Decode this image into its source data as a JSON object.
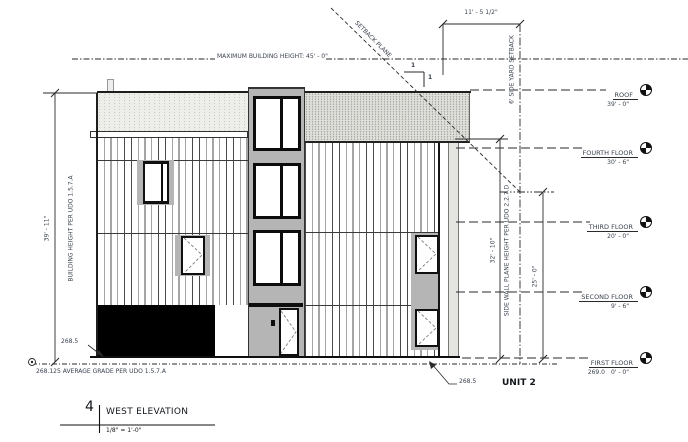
{
  "drawing": {
    "max_building_height_label": "MAXIMUM BUILDING HEIGHT: 45' - 0\"",
    "setback_plane_label": "SETBACK PLANE",
    "slope_rise": "1",
    "slope_run": "1",
    "setback_width_dim": "11' - 5 1/2\"",
    "side_yard_setback_label": "6' SIDE YARD SETBACK",
    "building_height_dim": "39' - 11\"",
    "building_height_label": "BUILDING HEIGHT PER UDO 1.5.7.A",
    "side_wall_height_dim": "32' - 10\"",
    "side_wall_label": "SIDE WALL PLANE HEIGHT PER UDO 2.2.7.D",
    "setback_plane_height_dim": "25' - 0\"",
    "average_grade_label": "268.125 AVERAGE GRADE PER UDO 1.5.7.A",
    "spot_grade_left": "268.5",
    "spot_grade_right": "268.5",
    "unit_label": "UNIT 2"
  },
  "levels": [
    {
      "name": "ROOF",
      "elevation": "39' - 0\""
    },
    {
      "name": "FOURTH FLOOR",
      "elevation": "30' - 6\""
    },
    {
      "name": "THIRD FLOOR",
      "elevation": "20' - 0\""
    },
    {
      "name": "SECOND FLOOR",
      "elevation": "9' - 6\""
    },
    {
      "name": "FIRST FLOOR",
      "elevation": "0' - 0\"",
      "datum": "269.0"
    }
  ],
  "title_block": {
    "number": "4",
    "title": "WEST ELEVATION",
    "scale": "1/8\" = 1'-0\""
  },
  "colors": {
    "ink": "#1f2429",
    "annotation_text": "#39414d",
    "tower_gray": "#b5b5b5",
    "stipple_light": "#ededea",
    "stipple_dense": "#dfdfda"
  }
}
